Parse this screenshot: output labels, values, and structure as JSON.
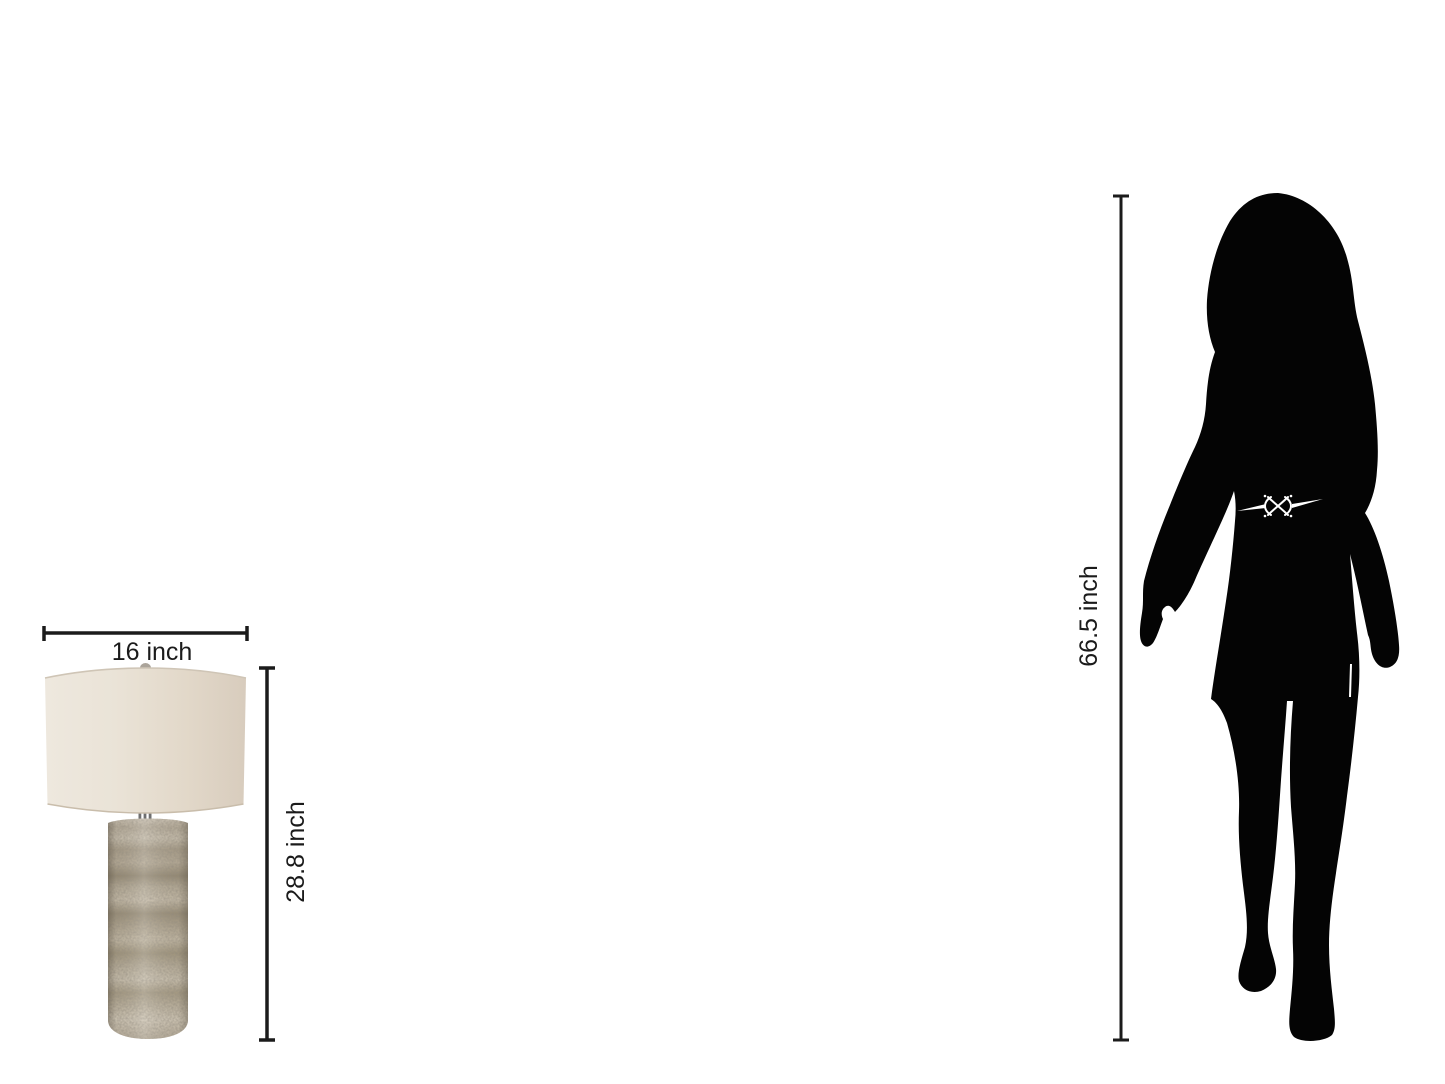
{
  "labels": {
    "lamp_width": "16 inch",
    "lamp_height": "28.8 inch",
    "person_height": "66.5 inch"
  },
  "colors": {
    "background": "#ffffff",
    "dimension_line": "#1b1b1b",
    "label_text": "#1b1b1b",
    "silhouette": "#040404",
    "belt_detail": "#ffffff",
    "lampshade_light": "#ece6dc",
    "lampshade_dark": "#d9cdbe",
    "lamp_base_light": "#cfc6b5",
    "lamp_base_mid": "#b0a590",
    "lamp_base_dark": "#8f8570",
    "lamp_metal": "#6f6f6f"
  }
}
